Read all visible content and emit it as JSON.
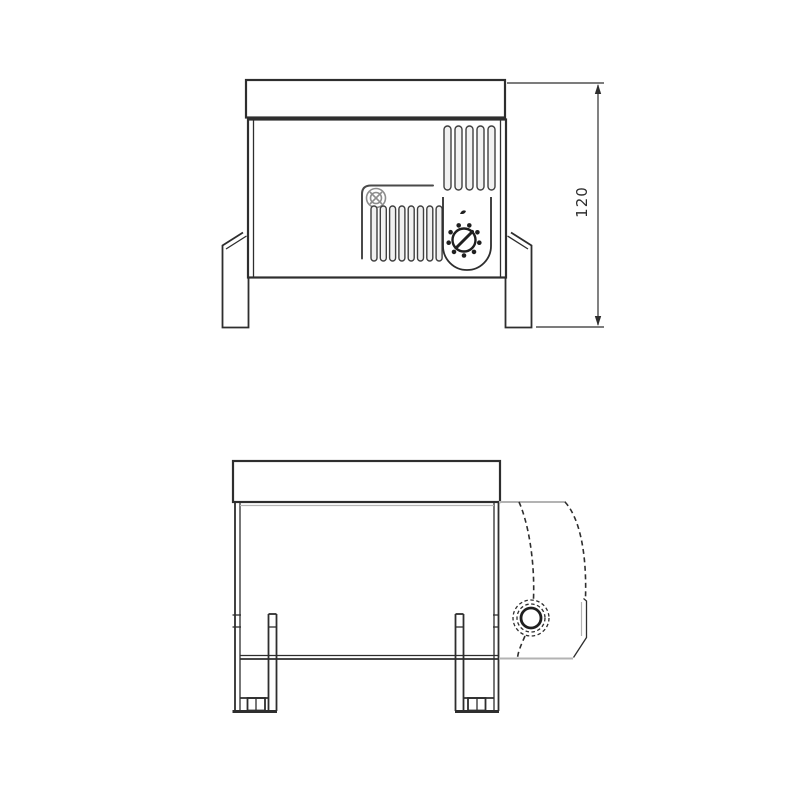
{
  "canvas": {
    "background": "#ffffff",
    "width": 800,
    "height": 800
  },
  "drawing": {
    "colors": {
      "line": "#2e2e2e",
      "light_line": "#b3b3b3",
      "screw_gray": "#8d8d8d",
      "slot_fill": "#f1f1f1",
      "background": "#ffffff"
    },
    "front_view": {
      "label": "front-elevation",
      "dimension": {
        "label": "120"
      },
      "vents_upper": {
        "count": 5,
        "x": 444,
        "y": 126,
        "width": 7,
        "height": 64,
        "pitch": 11
      },
      "vents_lower": {
        "count": 8,
        "x": 371,
        "y": 206,
        "width": 6,
        "height": 55,
        "pitch": 9.3
      },
      "knob_dots": {
        "cx": 464,
        "cy": 240,
        "ring_radius": 15.5,
        "dot_radius": 2.3,
        "count": 9
      }
    },
    "side_view": {
      "label": "side-elevation",
      "leg_count": 2
    }
  }
}
